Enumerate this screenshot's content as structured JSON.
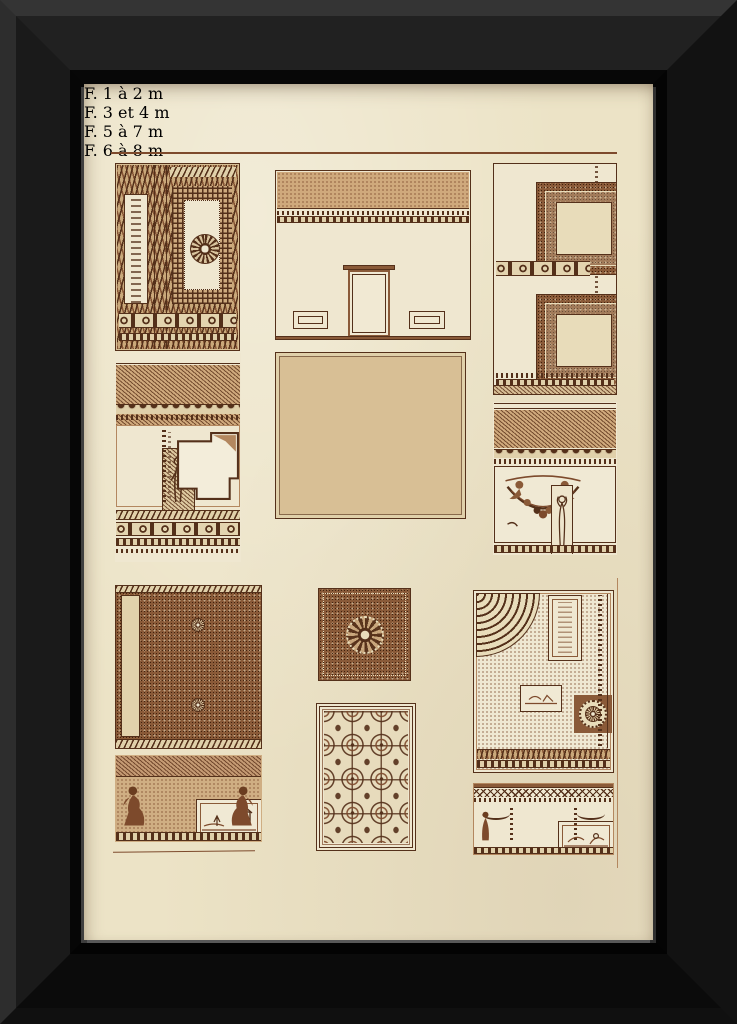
{
  "artwork": {
    "kind": "framed antique engraving plate",
    "subject": "Renaissance ceiling and wall decorations, sepia engraving",
    "frame_color": "#141414",
    "paper_color": "#ece3c6",
    "ink_color": "#7d4a2c"
  },
  "plate": {
    "scale_bars": [
      {
        "label": "F. 1 à 2",
        "end_label": "m"
      },
      {
        "label": "F. 3 et 4",
        "end_label": "m"
      },
      {
        "label": "F. 5 à 7",
        "end_label": "m"
      },
      {
        "label": "F. 6 à 8",
        "end_label": "m"
      }
    ],
    "panels": [
      "ceiling with guilloche bands and rosette",
      "wall elevation with pilasters and door",
      "ceiling coffers with sunburst rosettes",
      "cornice fragment with figure panel",
      "coffered ceiling grid",
      "entablature with garland frieze",
      "ceiling with octagonal coffers",
      "square coffer with medallions",
      "ceiling with octagon grid",
      "ceiling corner with quarter rosette",
      "frieze with seated figures",
      "frieze with landscape panel"
    ]
  }
}
